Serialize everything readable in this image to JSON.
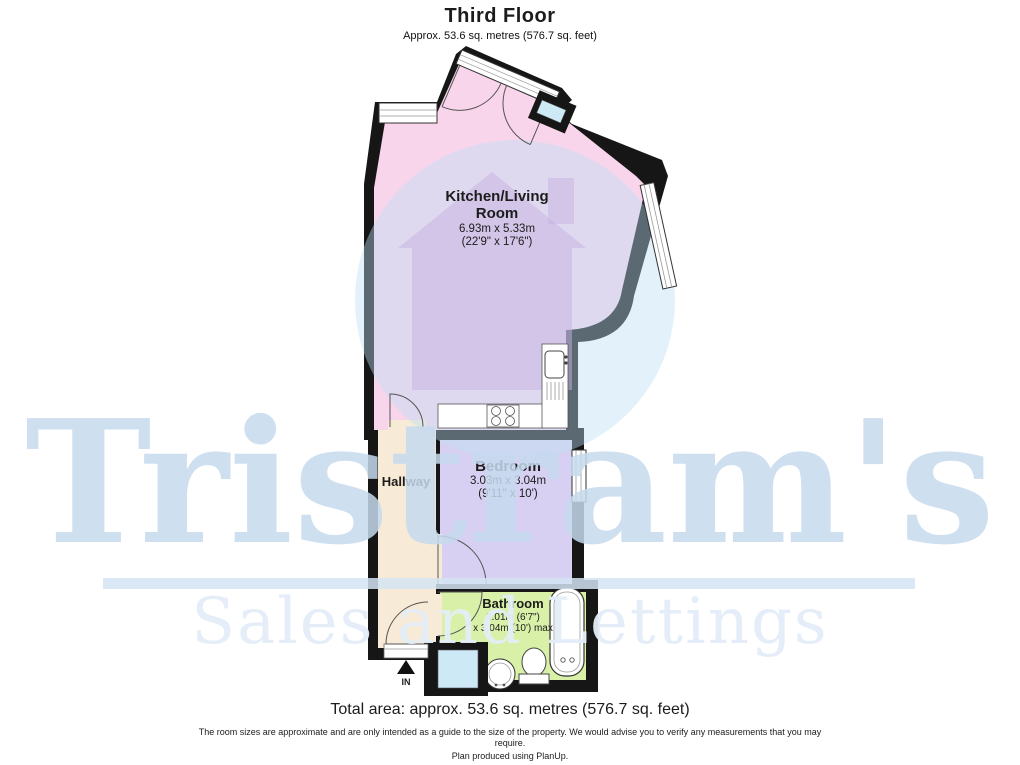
{
  "header": {
    "title": "Third Floor",
    "subtitle": "Approx. 53.6 sq. metres (576.7 sq. feet)"
  },
  "plan": {
    "rooms": {
      "kitchen": {
        "name_line1": "Kitchen/Living",
        "name_line2": "Room",
        "dims_metric": "6.93m x 5.33m",
        "dims_imperial": "(22'9\" x 17'6\")"
      },
      "hallway": {
        "name": "Hallway"
      },
      "bedroom": {
        "name": "Bedroom",
        "dims_metric": "3.03m x 3.04m",
        "dims_imperial": "(9'11\" x 10')"
      },
      "bathroom": {
        "name": "Bathroom",
        "dims_line1": "2.01m (6'7\")",
        "dims_line2": "x 3.04m (10') max"
      }
    },
    "entrance_label": "IN"
  },
  "watermark": {
    "name": "Tristram's",
    "tagline": "Sales and Lettings"
  },
  "footer": {
    "total_area": "Total area: approx. 53.6 sq. metres (576.7 sq. feet)",
    "disclaimer": "The room sizes are approximate and are only intended as a guide to the size of the property. We would advise you to verify any measurements that you may require.",
    "produced": "Plan produced using PlanUp."
  },
  "colors": {
    "wall": "#161616",
    "kitchen": "#f9d5ec",
    "hallway": "#f7ead6",
    "bedroom": "#d7d0f2",
    "bathroom": "#d9f0a8",
    "logo_circle": "#bcdff2",
    "logo_house": "#c7b2e2",
    "window_glass": "#cde9f6",
    "watermark_text": "#c6daee",
    "watermark_tagline": "#e4eef8"
  }
}
